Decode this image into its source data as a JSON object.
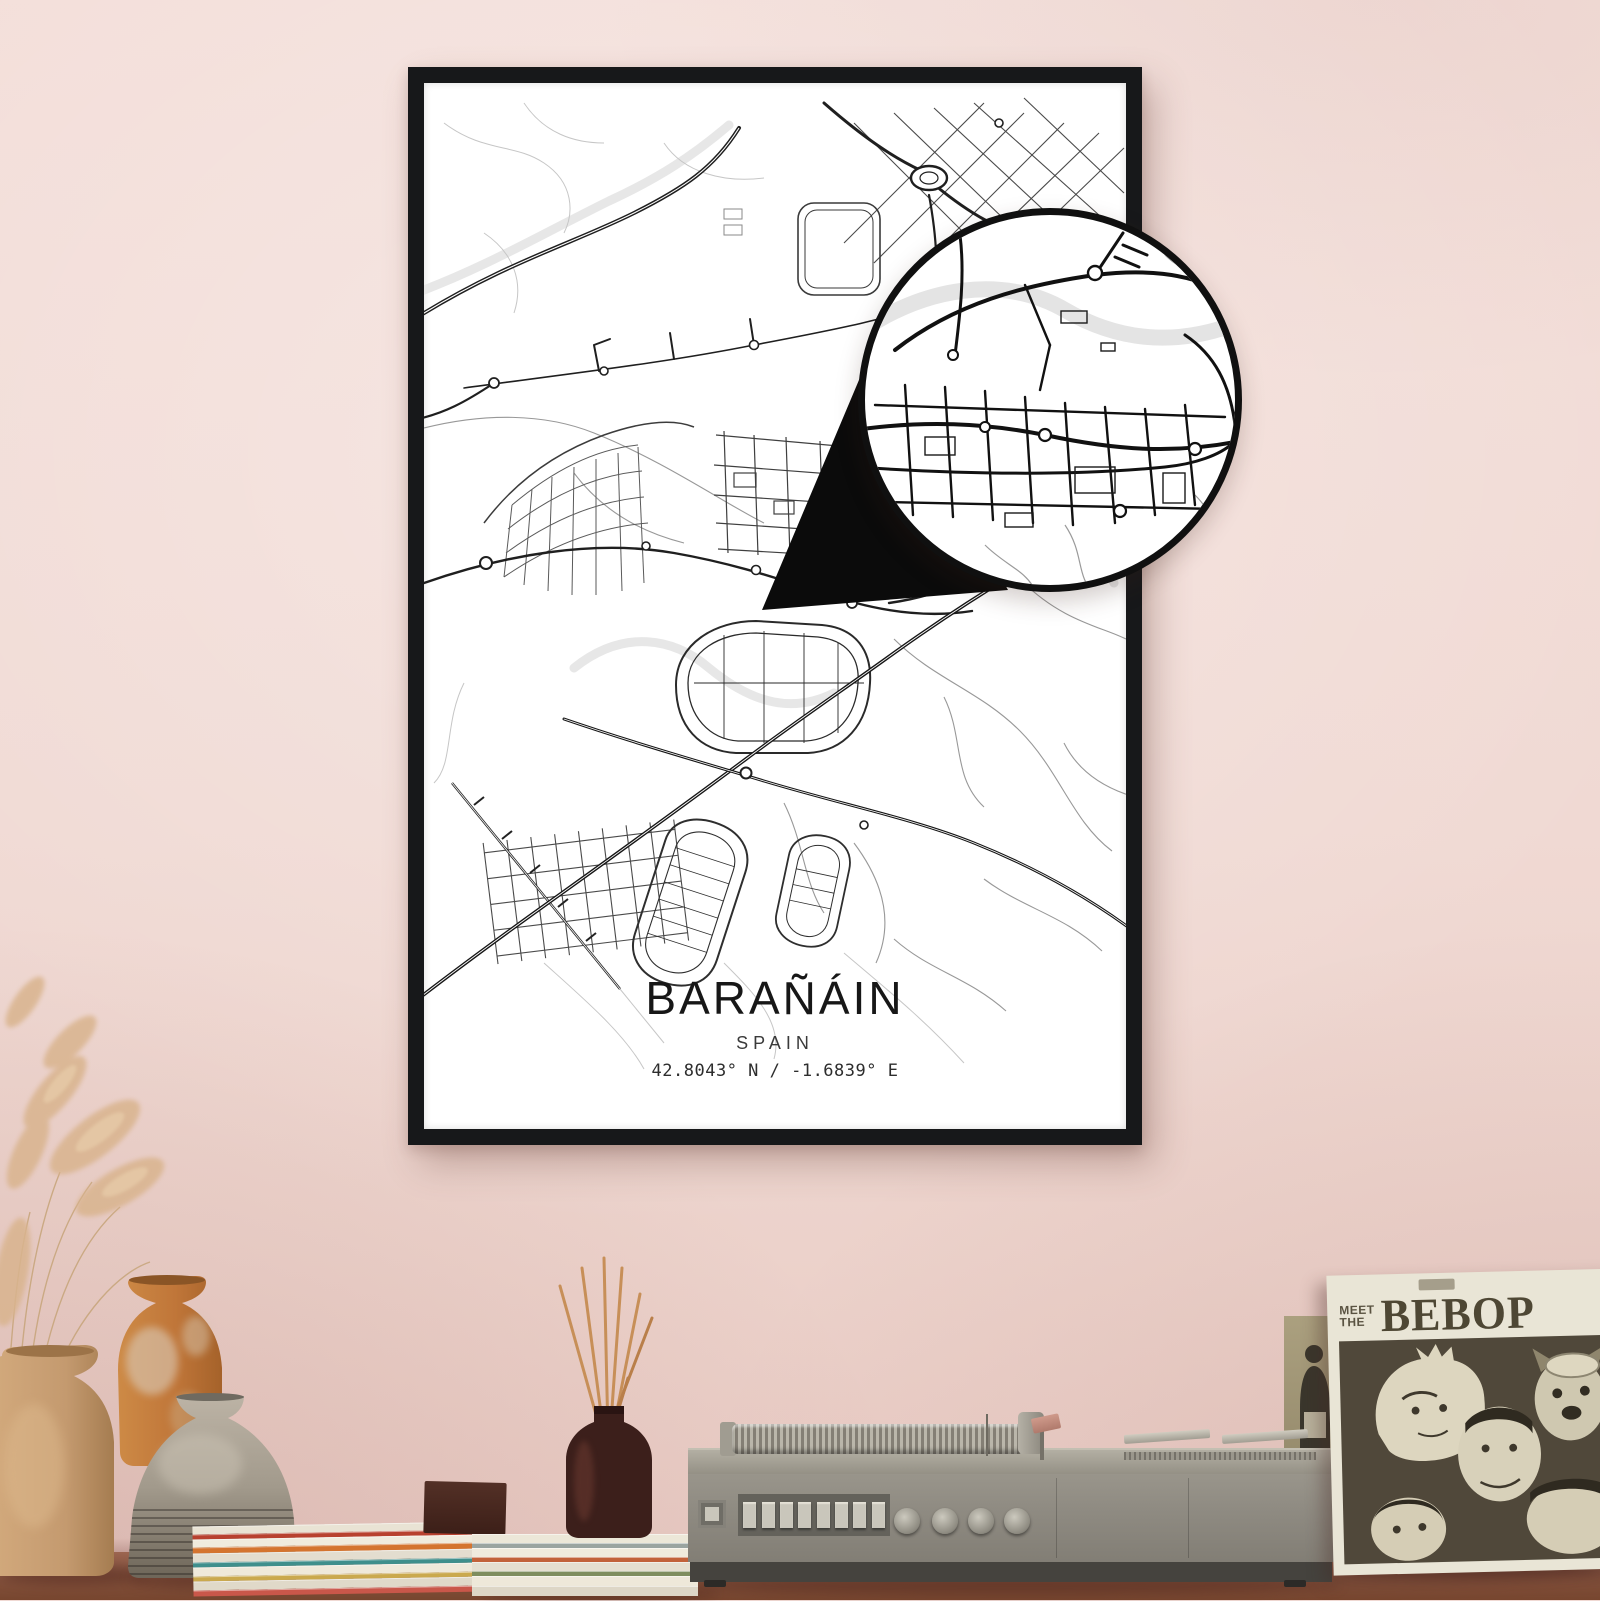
{
  "poster": {
    "title": "BARAÑÁIN",
    "country": "SPAIN",
    "coordinates": "42.8043° N / -1.6839° E"
  },
  "record_sleeve": {
    "line1": "MEET",
    "line2": "THE",
    "title": "BEBOP"
  },
  "colors": {
    "wall": "#f0d9d3",
    "frame": "#17181a",
    "poster_bg": "#ffffff",
    "map_ink": "#1f1f1f",
    "table_wood": "#8a5743",
    "turntable_gray": "#8f8b82",
    "sleeve_cream": "#e9e5d6",
    "sleeve_photo": "#50483a",
    "diffuser_brown": "#3c1f1b",
    "reed_tan": "#c78f58",
    "pampas_tan": "#d9b48e"
  }
}
